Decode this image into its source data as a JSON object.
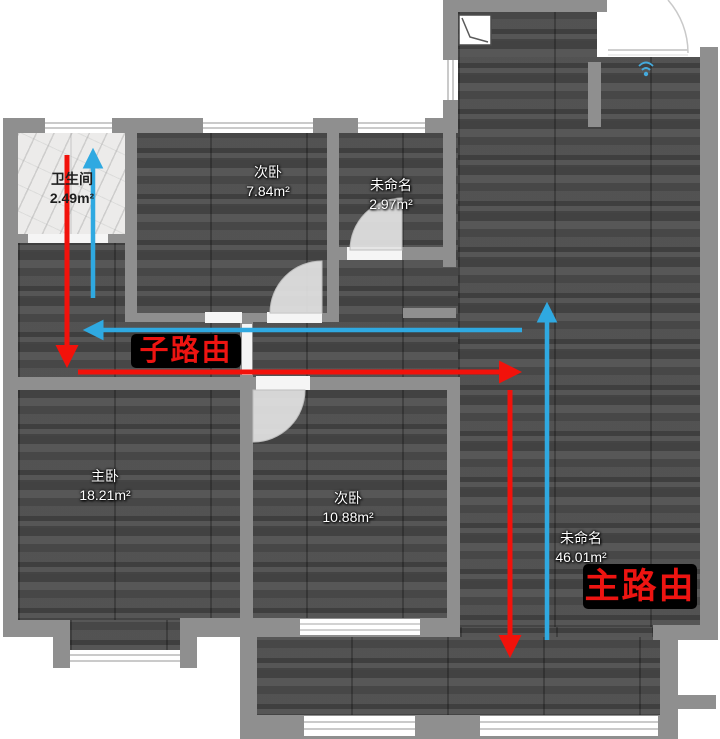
{
  "plan": {
    "type": "floor-plan",
    "rooms": [
      {
        "id": "bathroom",
        "name": "卫生间",
        "area": "2.49m²"
      },
      {
        "id": "bedroom-top",
        "name": "次卧",
        "area": "7.84m²"
      },
      {
        "id": "unnamed-small",
        "name": "未命名",
        "area": "2.97m²"
      },
      {
        "id": "master-bedroom",
        "name": "主卧",
        "area": "18.21m²"
      },
      {
        "id": "bedroom-bottom",
        "name": "次卧",
        "area": "10.88m²"
      },
      {
        "id": "unnamed-large",
        "name": "未命名",
        "area": "46.01m²"
      }
    ]
  },
  "annotations": {
    "sub_route_label": "子路由",
    "main_route_label": "主路由"
  },
  "icons": {
    "duct_symbol": "duct-symbol-icon",
    "router_marker": "router-marker-icon"
  },
  "colors": {
    "route_red": "#f2120b",
    "route_blue": "#2fa9e1",
    "route_label_text": "#ed1411",
    "route_label_bg": "#000000",
    "wall": "#8f8f8f",
    "floor_dark": "#4d4d4d",
    "bathroom_floor": "#ecebea"
  }
}
